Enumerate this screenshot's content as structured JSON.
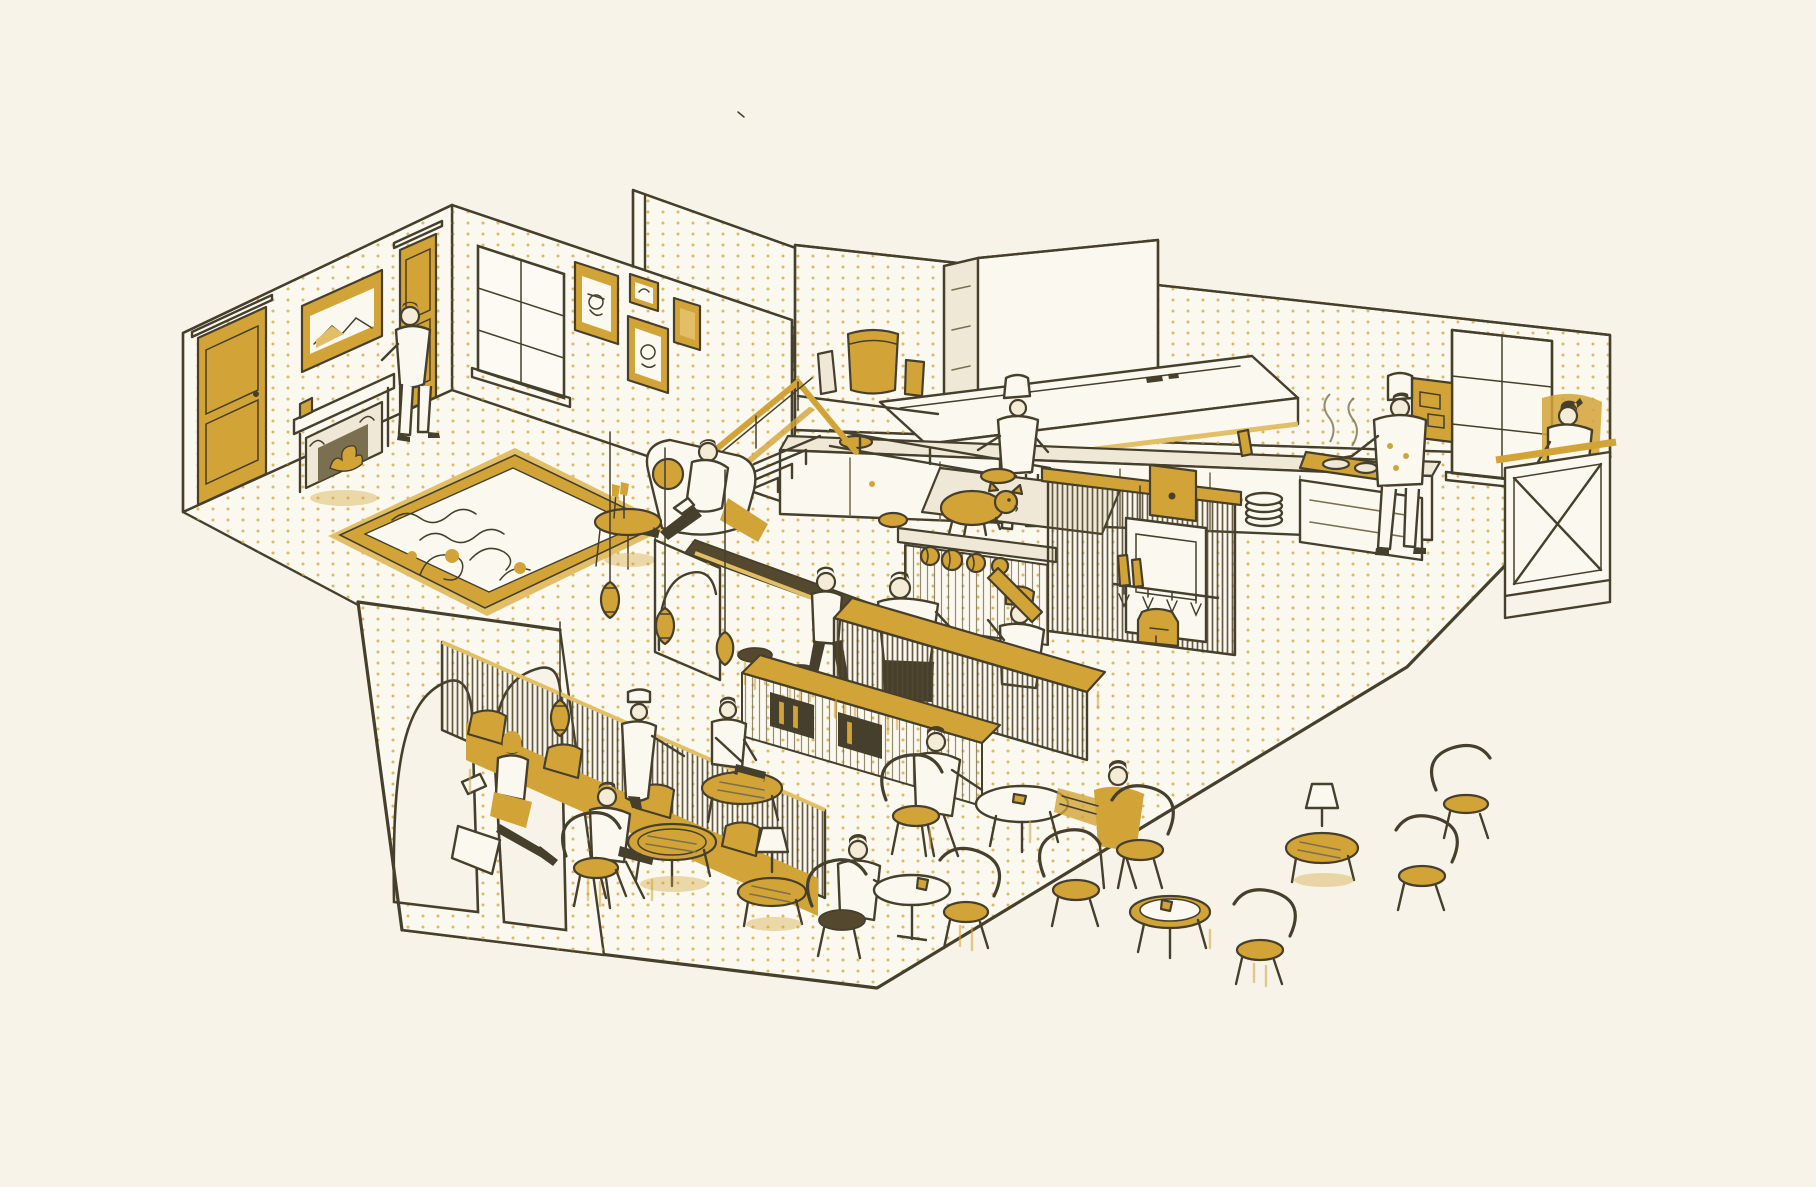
{
  "scene": {
    "title": "Isometric cutaway illustration of a café and lounge interior",
    "description": "Hand-drawn axonometric cutaway of a coffeehouse: a fireplace lounge at the upper left, an open raised kitchen with extractor hood at the top, a central coffee bar with baristas and a roast-pig pass display, a host desk at the right wall, and a café seating area with banquette, arched partition, lantern pendants, round tables and bentwood chairs in front. Surfaces carry a gold halftone dot texture on cream paper with dark olive ink linework.",
    "style": "two-tone sketch illustration, cream paper, olive-brown ink, mustard gold spot color, halftone dot shading",
    "people_count": 15
  },
  "palette": {
    "bg": "#f7f3e8",
    "ink": "#453f2c",
    "ink_soft": "#7a7050",
    "gold": "#d2a438",
    "gold_soft": "#e2bf66",
    "cream": "#fbf8ef",
    "cream_dark": "#efe8d6",
    "skin": "#f4ecd6",
    "wood_dark": "#54492f"
  },
  "rooms": [
    {
      "name": "lounge",
      "features": [
        "two gold panel doors",
        "carved fireplace with gold fire",
        "landscape painting in gold frame",
        "casement window",
        "gallery wall of four gold-framed portraits",
        "patterned rug with gold border",
        "armchair with reclining reader",
        "champagne side table",
        "stair with gold railing"
      ]
    },
    {
      "name": "open-kitchen",
      "features": [
        "extractor hood with chimney shaft",
        "long prep counter",
        "canister shelf",
        "roast pig on pass ledge",
        "pumpkins",
        "stacked plates",
        "steaming stove"
      ]
    },
    {
      "name": "coffee-bar",
      "features": [
        "slatted wood partition",
        "gold-topped service counter",
        "front island with bottle niches",
        "back-bar cabinet with espresso machine and hanging glasses",
        "bar rail with stools",
        "moroccan lantern pendants",
        "arched cream pillar"
      ]
    },
    {
      "name": "cafe-seating",
      "features": [
        "arched outer partition wall",
        "wood-slat banquette with gold cushions",
        "oval gold coffee tables",
        "round marble table",
        "bentwood chairs with gold seats",
        "shaded table lamps"
      ]
    },
    {
      "name": "host-station",
      "features": [
        "cross-braced host desk",
        "tall window",
        "abstract gold artwork",
        "gold wall wash behind receptionist"
      ]
    }
  ],
  "people": [
    {
      "role": "man leaning on fireplace mantel",
      "location": "lounge left wall"
    },
    {
      "role": "man reclining on armchair reading",
      "location": "lounge right"
    },
    {
      "role": "chef stirring bowl",
      "location": "kitchen prep counter"
    },
    {
      "role": "chef cooking at steaming stove",
      "location": "kitchen right"
    },
    {
      "role": "barista at service counter",
      "location": "coffee bar left"
    },
    {
      "role": "barista in gold cap pouring bottle",
      "location": "coffee bar right"
    },
    {
      "role": "server walking with order",
      "location": "between bar and seating"
    },
    {
      "role": "receptionist behind host desk",
      "location": "right wall"
    },
    {
      "role": "woman reading on banquette",
      "location": "seating area left"
    },
    {
      "role": "man seated on chair with laptop",
      "location": "seating area left"
    },
    {
      "role": "waiter in cap serving table",
      "location": "seating area center"
    },
    {
      "role": "man working on laptop at oval table",
      "location": "seating area center"
    },
    {
      "role": "man in white jacket at shared table",
      "location": "seating area right"
    },
    {
      "role": "man in gold jacket reading paper",
      "location": "seating area right"
    },
    {
      "role": "person seated at round marble table",
      "location": "seating area front"
    }
  ],
  "furniture": {
    "tables": [
      "oval gold coffee table x3",
      "cream shared oval table",
      "round marble pedestal table",
      "gold-rim round table",
      "lamp side table x2",
      "champagne side table"
    ],
    "chairs": [
      "bentwood chair with gold cushion x8",
      "bar stool x4",
      "banquette bench",
      "lounge armchair"
    ],
    "counters": [
      "gold-top service counter",
      "front island with niches",
      "bar rail",
      "kitchen prep counter",
      "stove counter",
      "pass ledge"
    ]
  },
  "lighting": [
    "moroccan lantern pendant x4",
    "cream shaded table lamp x2"
  ],
  "decor": [
    "patterned rug",
    "gold framed portraits x4",
    "mantel landscape painting",
    "abstract gold artwork",
    "menu boards",
    "roast pig display",
    "wine glasses",
    "gold pitcher",
    "halftone gold dot texture"
  ]
}
